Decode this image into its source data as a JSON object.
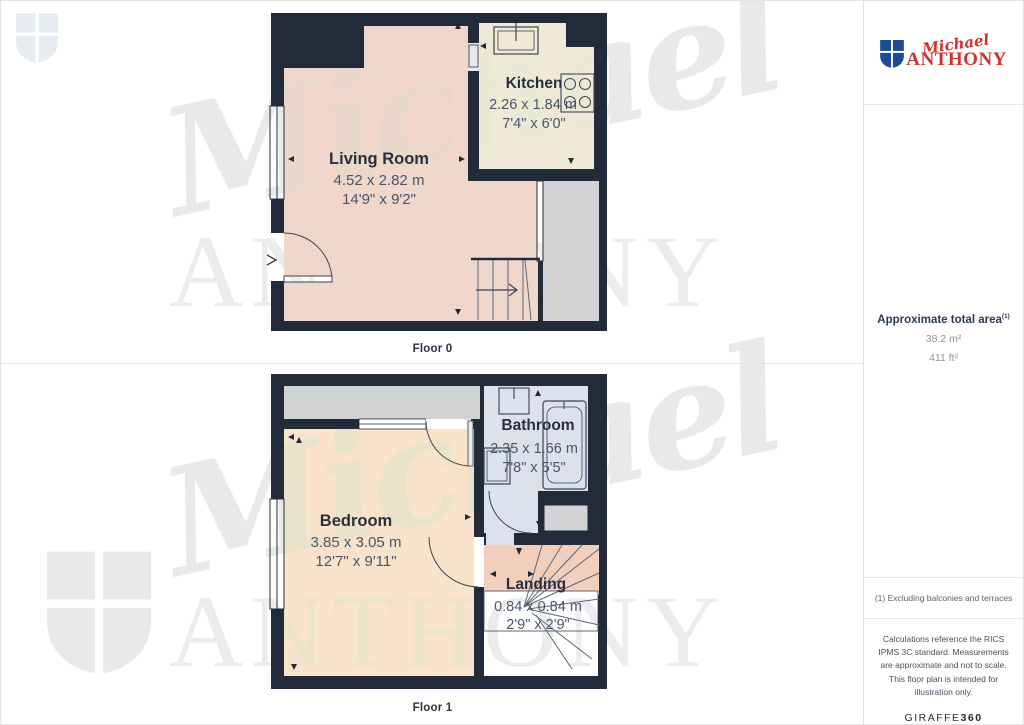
{
  "branding": {
    "logo_script": "Michael",
    "logo_caps": "ANTHONY",
    "watermark_script": "Michael",
    "watermark_caps": "ANTHONY",
    "colors": {
      "logo_red": "#d23230",
      "logo_blue": "#1e4c92",
      "watermark_gray": "#e9e9e9"
    }
  },
  "plan_colors": {
    "wall": "#212b39",
    "living_room": "#f1d7cb",
    "kitchen": "#efe9d6",
    "bedroom": "#fae3cb",
    "bathroom": "#dce1ed",
    "landing": "#f2cfbc",
    "gray_area": "#d2d3d5"
  },
  "floors": [
    {
      "label": "Floor 0",
      "rooms": [
        {
          "name": "Living Room",
          "metric": "4.52 x 2.82 m",
          "imperial": "14'9\" x 9'2\""
        },
        {
          "name": "Kitchen",
          "metric": "2.26 x 1.84 m",
          "imperial": "7'4\" x 6'0\""
        }
      ]
    },
    {
      "label": "Floor 1",
      "rooms": [
        {
          "name": "Bedroom",
          "metric": "3.85 x 3.05 m",
          "imperial": "12'7\" x 9'11\""
        },
        {
          "name": "Bathroom",
          "metric": "2.35 x 1.66 m",
          "imperial": "7'8\" x 5'5\""
        },
        {
          "name": "Landing",
          "metric": "0.84 x 0.84 m",
          "imperial": "2'9\" x 2'9\""
        }
      ]
    }
  ],
  "sidebar": {
    "total_area_label": "Approximate total area",
    "total_area_sup": "(1)",
    "total_area_m2": "38.2 m²",
    "total_area_ft2": "411 ft²",
    "footnote": "(1) Excluding balconies and terraces",
    "disclaimer": "Calculations reference the RICS IPMS 3C standard. Measurements are approximate and not to scale. This floor plan is intended for illustration only.",
    "brand_name": "GIRAFFE",
    "brand_number": "360"
  }
}
